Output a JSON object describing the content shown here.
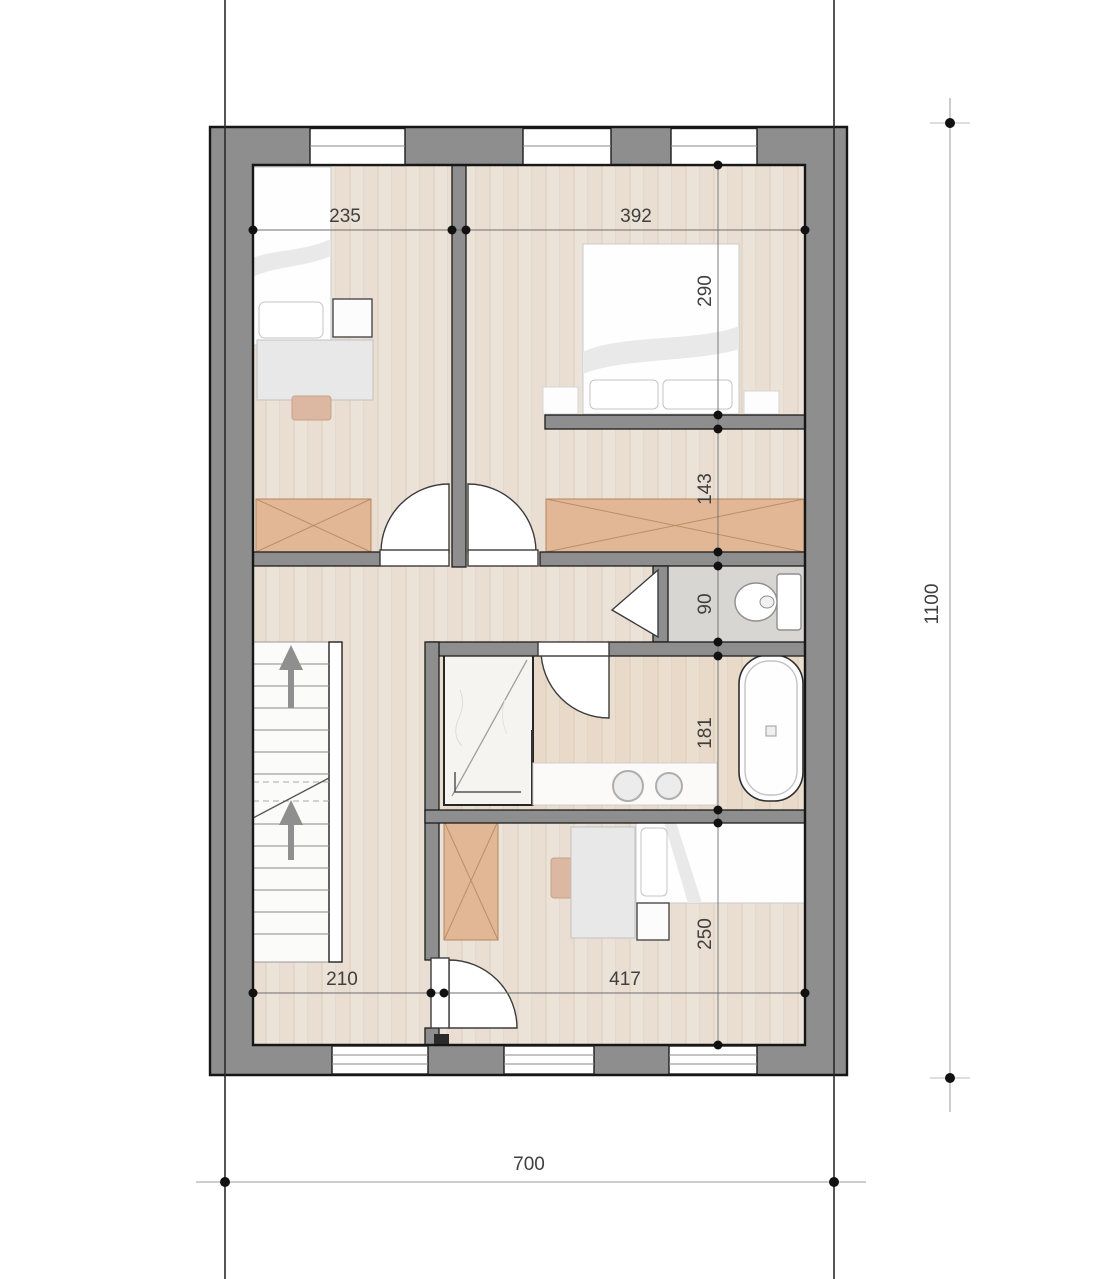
{
  "document": {
    "kind": "architectural-floor-plan"
  },
  "dims": {
    "room_tl_width": "235",
    "room_tr_width": "392",
    "room_tr_depth": "290",
    "closet_depth": "143",
    "wc_depth": "90",
    "bath_depth": "181",
    "room_b_depth": "250",
    "hall_width": "210",
    "room_b_width": "417",
    "overall_width": "700",
    "overall_height": "1100"
  },
  "colors": {
    "wall": "#8e8e8e",
    "outline": "#161616",
    "floor_wood": "#ece3d8",
    "wardrobe": "#e2b795",
    "wardrobe_line": "#b3875f",
    "wc_floor": "#d8d6d2",
    "dim_text": "#3f3f3f",
    "dim_line": "#6e6e6e"
  },
  "icons": {
    "stairs_up_arrow": "up-arrow",
    "toilet": "toilet-icon",
    "bathtub": "bathtub-icon",
    "shower": "shower-icon",
    "sinks": "double-sink-icon"
  }
}
